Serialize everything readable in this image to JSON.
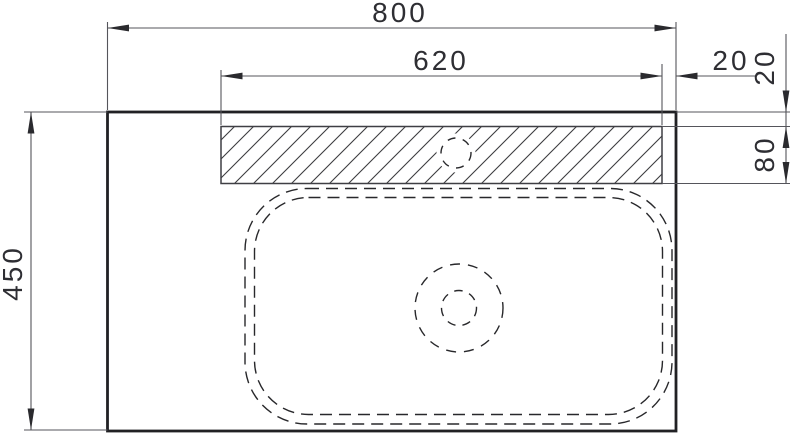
{
  "drawing": {
    "title": "Washbasin countertop — top view dimensional drawing",
    "labels": {
      "overall_width": "800",
      "cutout_width": "620",
      "cutout_right_offset": "20",
      "cutout_top_offset": "20",
      "cutout_height": "80",
      "overall_depth": "450"
    },
    "colors": {
      "background": "#ffffff",
      "main_outline": "#212124",
      "hatch_and_borders": "#3f3f44",
      "hidden_dashed_lines": "#28282b",
      "dimension_lines": "#55555b",
      "dimension_text": "#2e2e33"
    }
  }
}
